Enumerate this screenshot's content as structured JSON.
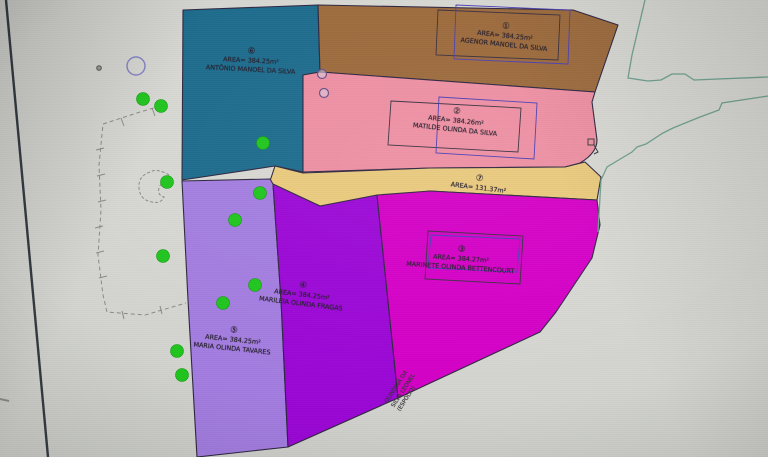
{
  "drawing": {
    "parcels": [
      {
        "id": 1,
        "num": "①",
        "area_label": "AREA= 384.25m²",
        "name": "AGENOR MANOEL DA SILVA",
        "color": "#9c6a3c"
      },
      {
        "id": 2,
        "num": "②",
        "area_label": "AREA= 384.26m²",
        "name": "MATILDE OLINDA DA SILVA",
        "color": "#ee8fa3"
      },
      {
        "id": 3,
        "num": "③",
        "area_label": "AREA= 384.27m²",
        "name": "MARINETE OLINDA BETTENCOURT",
        "color": "#d400c6"
      },
      {
        "id": 4,
        "num": "④",
        "area_label": "AREA= 384.25m²",
        "name": "MARILEIA OLINDA FRAGAS",
        "color": "#9b07d6"
      },
      {
        "id": 5,
        "num": "⑤",
        "area_label": "AREA= 384.25m²",
        "name": "MARIA OLINDA TAVARES",
        "color": "#a37de0"
      },
      {
        "id": 6,
        "num": "⑥",
        "area_label": "AREA= 384.25m²",
        "name": "ANTÔNIO MANOEL DA SILVA",
        "color": "#1c6b8d"
      },
      {
        "id": 7,
        "num": "⑦",
        "area_label": "AREA= 131.37m²",
        "name": "",
        "color": "#e9c97c"
      }
    ],
    "road_label_lines": [
      "OLINDINA DA",
      "SILVA LEONEL",
      "(ESPÓLIO)"
    ],
    "colors": {
      "parcel_outline": "#2e2640",
      "label_box_blue": "#4a3fb5",
      "label_box_dark": "#3a3040",
      "road_line": "#6fa08f",
      "survey_dot_green": "#1fc51d",
      "dashed_boundary": "#8a8a86",
      "screen_edge_line": "#343a40",
      "background": "#d4d5d0"
    }
  }
}
